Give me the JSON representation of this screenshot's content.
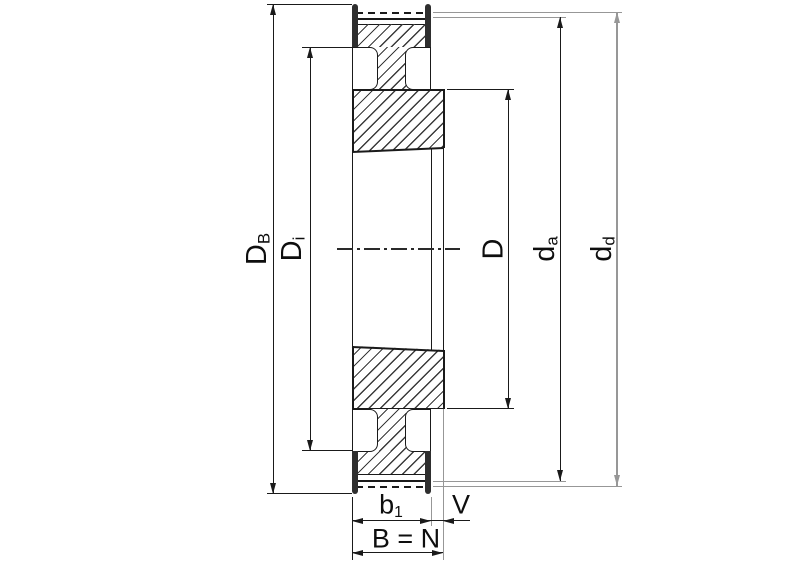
{
  "drawing": {
    "title": "taper-bush-timing-pulley-cross-section",
    "labels": {
      "db": {
        "main": "D",
        "sub": "B"
      },
      "di": {
        "main": "D",
        "sub": "i"
      },
      "d": {
        "main": "D"
      },
      "da": {
        "main": "d",
        "sub": "a"
      },
      "dd": {
        "main": "d",
        "sub": "d"
      },
      "b1": {
        "main": "b",
        "sub": "1"
      },
      "v": {
        "main": "V"
      },
      "bn": {
        "main": "B = N"
      }
    },
    "colors": {
      "line": "#1a1a1a",
      "extension_gray": "#979797",
      "flange_fill": "#2e2e2e",
      "hatch": "#3a3a3a",
      "background": "#ffffff"
    }
  }
}
